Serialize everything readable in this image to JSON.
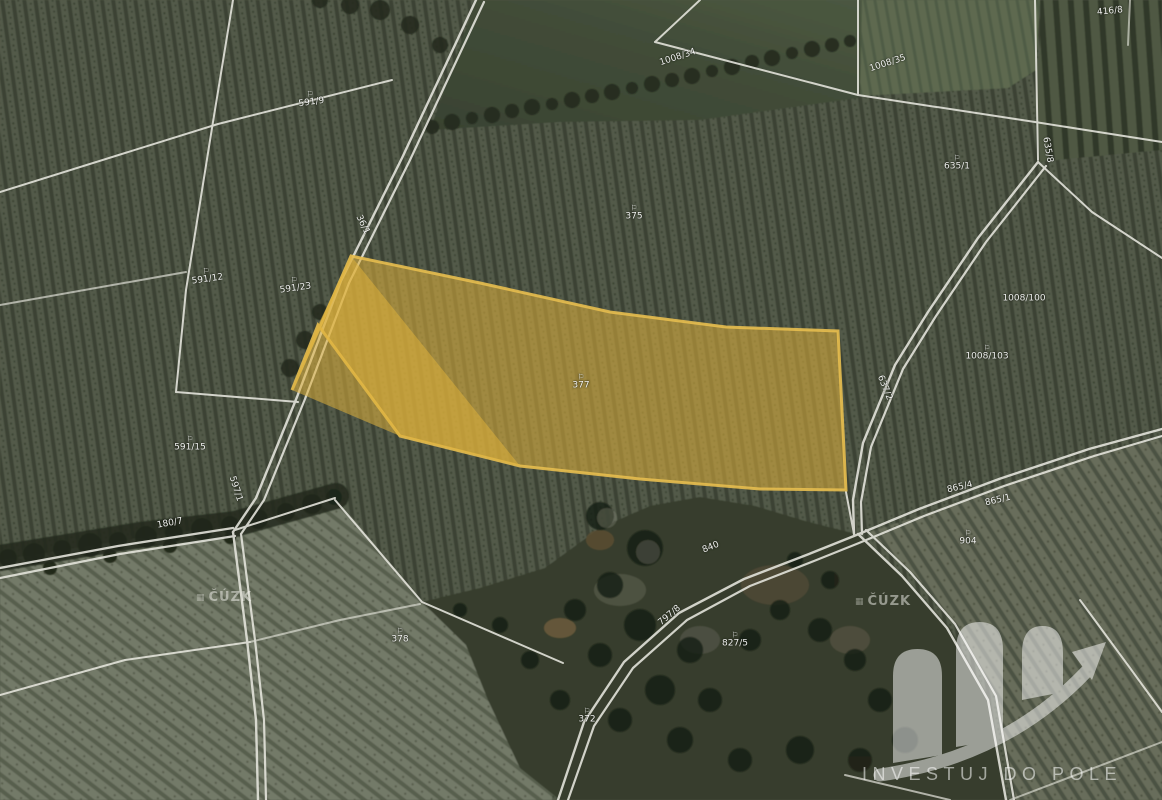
{
  "map": {
    "source_watermark": "ČÚZK",
    "brand": {
      "name": "INVESTUJ DO POLE"
    },
    "highlight": {
      "fill": "#e9b83a",
      "stroke": "#f2c44f",
      "parcel_label": "377"
    },
    "colors": {
      "boundary_line": "#efeee6",
      "label_text": "#ffffff"
    },
    "symbols": {
      "landuse_flag": "⚐"
    },
    "labels": [
      {
        "text": "591/9",
        "x": 311,
        "y": 99,
        "rot": -8,
        "sym": true
      },
      {
        "text": "591/12",
        "x": 207,
        "y": 276,
        "rot": -8,
        "sym": true
      },
      {
        "text": "591/23",
        "x": 295,
        "y": 285,
        "rot": -8,
        "sym": true
      },
      {
        "text": "591/15",
        "x": 190,
        "y": 444,
        "rot": 0,
        "sym": true
      },
      {
        "text": "375",
        "x": 634,
        "y": 213,
        "rot": 0,
        "sym": true
      },
      {
        "text": "377",
        "x": 581,
        "y": 382,
        "rot": 0,
        "sym": true
      },
      {
        "text": "1008/34",
        "x": 678,
        "y": 58,
        "rot": -18,
        "sym": false
      },
      {
        "text": "1008/35",
        "x": 888,
        "y": 64,
        "rot": -18,
        "sym": false
      },
      {
        "text": "635/1",
        "x": 957,
        "y": 163,
        "rot": 0,
        "sym": true
      },
      {
        "text": "635/8",
        "x": 1047,
        "y": 150,
        "rot": 80,
        "sym": false
      },
      {
        "text": "1008/100",
        "x": 1024,
        "y": 299,
        "rot": 0,
        "sym": false
      },
      {
        "text": "1008/103",
        "x": 987,
        "y": 353,
        "rot": 0,
        "sym": true
      },
      {
        "text": "637/2",
        "x": 884,
        "y": 388,
        "rot": 68,
        "sym": false
      },
      {
        "text": "36/1",
        "x": 362,
        "y": 225,
        "rot": 64,
        "sym": false
      },
      {
        "text": "597/1",
        "x": 235,
        "y": 489,
        "rot": 72,
        "sym": false
      },
      {
        "text": "180/7",
        "x": 170,
        "y": 524,
        "rot": -10,
        "sym": false
      },
      {
        "text": "797/8",
        "x": 670,
        "y": 616,
        "rot": -40,
        "sym": false
      },
      {
        "text": "840",
        "x": 711,
        "y": 548,
        "rot": -22,
        "sym": false
      },
      {
        "text": "865/4",
        "x": 960,
        "y": 488,
        "rot": -13,
        "sym": false
      },
      {
        "text": "865/1",
        "x": 998,
        "y": 501,
        "rot": -13,
        "sym": false
      },
      {
        "text": "904",
        "x": 968,
        "y": 538,
        "rot": 0,
        "sym": true
      },
      {
        "text": "827/5",
        "x": 735,
        "y": 640,
        "rot": 0,
        "sym": true
      },
      {
        "text": "378",
        "x": 400,
        "y": 636,
        "rot": 0,
        "sym": true
      },
      {
        "text": "372",
        "x": 587,
        "y": 716,
        "rot": 0,
        "sym": true
      },
      {
        "text": "416/8",
        "x": 1110,
        "y": 12,
        "rot": -6,
        "sym": false
      }
    ]
  }
}
